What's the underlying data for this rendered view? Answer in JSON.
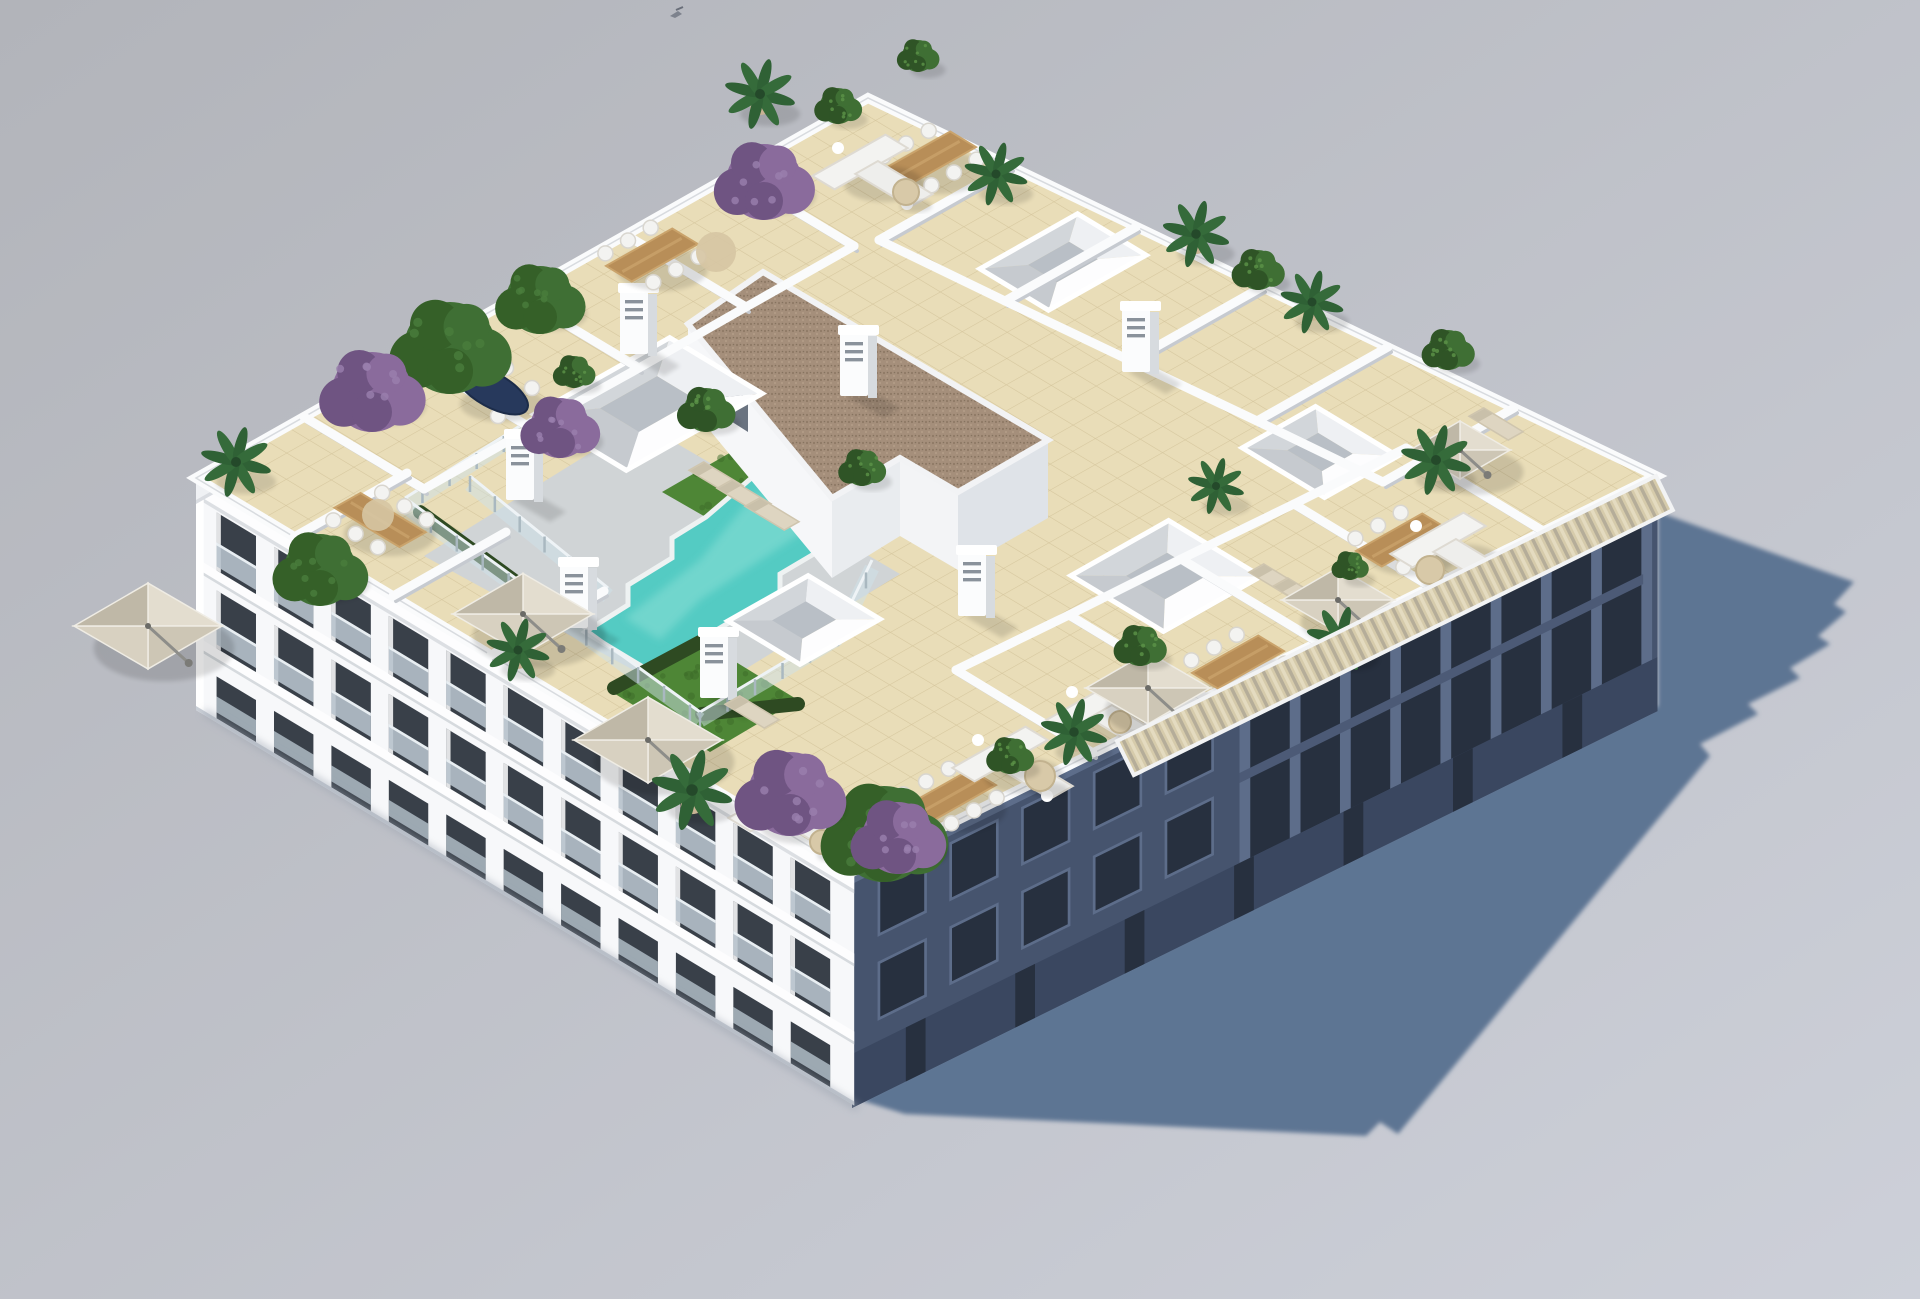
{
  "image": {
    "type": "3d-architectural-render",
    "view": "aerial-axonometric",
    "subject": "White residential apartment block with communal rooftop pool terrace",
    "background": "plain light-gray studio ground",
    "lighting": "sunlit from upper-left, hard shadow cast to the right"
  },
  "colors": {
    "ground_top": "#b2b4ba",
    "ground_bottom": "#cdd0d9",
    "shadow": "#5d7493",
    "building_white": "#f7f8fa",
    "facade_band": "#fdfdfe",
    "facade_shade": "#e7eaee",
    "facade_dark": "#46546e",
    "facade_dark_deep": "#27303f",
    "facade_pillar": "#5d6d8a",
    "window_dark": "#394049",
    "glass_balustrade": "#b7c3cd",
    "roof_tile": "#e9ddb8",
    "roof_grout": "#d5c69d",
    "parapet": "#fafbfc",
    "wall_shade": "#dcdfe4",
    "deck": "#d0d4d6",
    "pool_water": "#54cbc3",
    "pool_light": "#8adfd6",
    "pool_coping": "#eef2f2",
    "grass": "#4e8636",
    "grass_dark": "#3c6a28",
    "hedge": "#2e4a22",
    "gravel_roof": "#a58f7b",
    "gravel_dark": "#8f7a66",
    "umbrella": "#d9d2c2",
    "umbrella_shade": "#c4bcab",
    "wood": "#b88e58",
    "wood_light": "#caa36b",
    "furniture_white": "#f3f3f1",
    "lounger": "#ded5c1",
    "navy_table": "#27395c",
    "plant_green": "#3f6f34",
    "plant_green_dark": "#2f5426",
    "plant_palm": "#356b3a",
    "plant_purple": "#8a6b9c",
    "plant_purple_dark": "#6f5482",
    "pot": "#c9b394",
    "jute": "#d6c5a3",
    "glass_fence": "#cfe2ea",
    "pergola_light": "#d6cbab",
    "pergola_dark": "#b5ad99"
  },
  "scene": {
    "building": {
      "floors_visible": 3,
      "sw_facade": {
        "style": "sunlit white, recessed balconies with glass rails",
        "floors": 3,
        "bays": 11
      },
      "se_facade": {
        "style": "in shade, blue-gray, punched windows and pillared balconies",
        "window_count": 5,
        "pillar_count": 9
      },
      "pergola": "cane/bamboo slat canopy along the south-east roof edge"
    },
    "rooftop_features": [
      {
        "name": "swimming-pool",
        "count": 1,
        "shape": "stepped diagonal"
      },
      {
        "name": "pool-deck",
        "count": 1
      },
      {
        "name": "lawn-patch",
        "count": 2
      },
      {
        "name": "glass-pool-fence",
        "count": 1
      },
      {
        "name": "hedge-strip",
        "count": 3
      },
      {
        "name": "stairwell-gravel-roof",
        "count": 1
      },
      {
        "name": "skylight",
        "count": 5
      },
      {
        "name": "chimney",
        "count": 7
      },
      {
        "name": "parasol",
        "count": 6
      },
      {
        "name": "dining-set",
        "count": 6
      },
      {
        "name": "oval-navy-table",
        "count": 1
      },
      {
        "name": "corner-sofa",
        "count": 5
      },
      {
        "name": "sun-lounger",
        "count": 7
      },
      {
        "name": "round-side-table",
        "count": 5
      },
      {
        "name": "jute-rug",
        "count": 2
      },
      {
        "name": "palm-plant",
        "count": 11
      },
      {
        "name": "round-tree",
        "count": 4
      },
      {
        "name": "bougainvillea-purple",
        "count": 5
      },
      {
        "name": "shrub-pot",
        "count": 10
      },
      {
        "name": "terrace-divider-walls",
        "count": 18
      }
    ],
    "shadow": {
      "direction": "cast toward the right (east) with jagged parapet silhouette"
    },
    "extras": [
      {
        "name": "bird",
        "position": "top-center sky"
      }
    ]
  }
}
